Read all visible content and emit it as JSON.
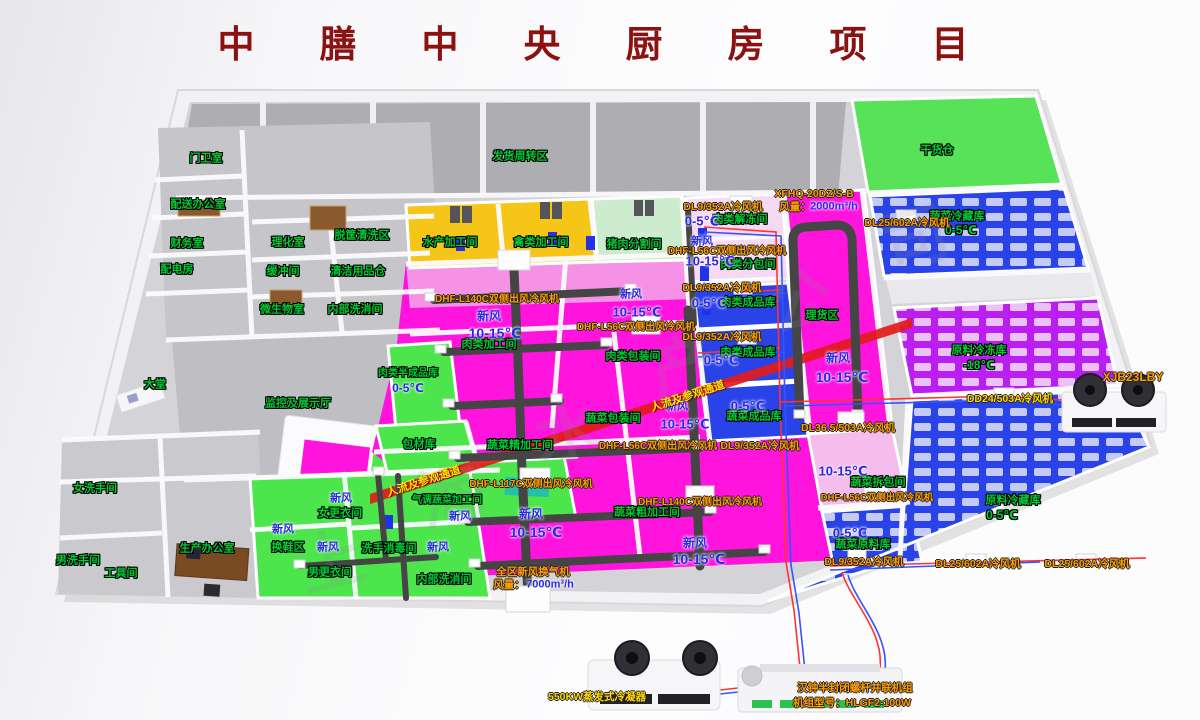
{
  "title": {
    "text": "中　膳　中　央　厨　房　项　目"
  },
  "colors": {
    "magenta_floor": "#ff14dd",
    "green_floor": "#4ce64c",
    "cold_blue_floor": "#2a43e8",
    "freezer_purple_floor": "#b81ff0",
    "yellow_room": "#f5c518",
    "pale_green_room": "#cdeccd",
    "dock_gray": "#aeaeb2",
    "light_pink": "#f4bdec",
    "corridor_red": "#e21b1b",
    "duct_gray": "#454545",
    "label_green": "#00cc33",
    "label_blue": "#2a2ae2",
    "label_orange": "#ff9d00",
    "label_yellow": "#ffd900",
    "title_red": "#8c1212"
  },
  "watermark": {
    "marks": [
      {
        "t": "上",
        "x": 330,
        "y": 557
      },
      {
        "t": "海",
        "x": 450,
        "y": 492
      },
      {
        "t": "水",
        "x": 566,
        "y": 428
      },
      {
        "t": "产",
        "x": 682,
        "y": 363
      },
      {
        "t": "公",
        "x": 798,
        "y": 298
      },
      {
        "t": "司",
        "x": 914,
        "y": 233
      }
    ]
  },
  "labels": [
    {
      "t": "门卫室",
      "x": 206,
      "y": 159,
      "c": "g"
    },
    {
      "t": "配送办公室",
      "x": 198,
      "y": 205,
      "c": "g"
    },
    {
      "t": "财务室",
      "x": 187,
      "y": 244,
      "c": "g"
    },
    {
      "t": "配电房",
      "x": 177,
      "y": 270,
      "c": "g"
    },
    {
      "t": "理化室",
      "x": 288,
      "y": 243,
      "c": "g"
    },
    {
      "t": "脱筐清洗区",
      "x": 362,
      "y": 236,
      "c": "g"
    },
    {
      "t": "缓冲间",
      "x": 283,
      "y": 272,
      "c": "g"
    },
    {
      "t": "清洁用品仓",
      "x": 358,
      "y": 272,
      "c": "g"
    },
    {
      "t": "微生物室",
      "x": 282,
      "y": 310,
      "c": "g"
    },
    {
      "t": "内部洗消间",
      "x": 355,
      "y": 310,
      "c": "g"
    },
    {
      "t": "大堂",
      "x": 155,
      "y": 385,
      "c": "g"
    },
    {
      "t": "监控及展示厅",
      "x": 298,
      "y": 404,
      "c": "g"
    },
    {
      "t": "女洗手间",
      "x": 95,
      "y": 489,
      "c": "g"
    },
    {
      "t": "男洗手间",
      "x": 78,
      "y": 561,
      "c": "g"
    },
    {
      "t": "工具间",
      "x": 121,
      "y": 574,
      "c": "g"
    },
    {
      "t": "生产办公室",
      "x": 207,
      "y": 549,
      "c": "g"
    },
    {
      "t": "换鞋区",
      "x": 288,
      "y": 548,
      "c": "g"
    },
    {
      "t": "女更衣间",
      "x": 340,
      "y": 514,
      "c": "g"
    },
    {
      "t": "男更衣间",
      "x": 330,
      "y": 573,
      "c": "g"
    },
    {
      "t": "洗手消毒间",
      "x": 389,
      "y": 549,
      "c": "g"
    },
    {
      "t": "包材库",
      "x": 419,
      "y": 445,
      "c": "g"
    },
    {
      "t": "气调蔬菜加工间",
      "x": 447,
      "y": 501,
      "c": "g",
      "fs": 10
    },
    {
      "t": "内部洗消间",
      "x": 444,
      "y": 580,
      "c": "g"
    },
    {
      "t": "水产加工间",
      "x": 450,
      "y": 243,
      "c": "g"
    },
    {
      "t": "禽类加工间",
      "x": 541,
      "y": 243,
      "c": "g"
    },
    {
      "t": "猪肉分割间",
      "x": 634,
      "y": 245,
      "c": "g"
    },
    {
      "t": "肉类加工间",
      "x": 489,
      "y": 345,
      "c": "g"
    },
    {
      "t": "肉类半成品库",
      "x": 408,
      "y": 374,
      "c": "g",
      "fs": 10
    },
    {
      "t": "肉类解冻间",
      "x": 740,
      "y": 220,
      "c": "g"
    },
    {
      "t": "肉类分包间",
      "x": 748,
      "y": 265,
      "c": "g"
    },
    {
      "t": "肉类成品库",
      "x": 748,
      "y": 303,
      "c": "g"
    },
    {
      "t": "肉类包装间",
      "x": 633,
      "y": 357,
      "c": "g"
    },
    {
      "t": "肉类成品库",
      "x": 748,
      "y": 353,
      "c": "g"
    },
    {
      "t": "理货区",
      "x": 822,
      "y": 316,
      "c": "g"
    },
    {
      "t": "蔬菜包装间",
      "x": 613,
      "y": 419,
      "c": "g"
    },
    {
      "t": "蔬菜成品库",
      "x": 754,
      "y": 417,
      "c": "g"
    },
    {
      "t": "蔬菜精加工间",
      "x": 520,
      "y": 446,
      "c": "g"
    },
    {
      "t": "蔬菜粗加工间",
      "x": 647,
      "y": 513,
      "c": "g"
    },
    {
      "t": "蔬菜拆包间",
      "x": 878,
      "y": 483,
      "c": "g"
    },
    {
      "t": "蔬菜原料库",
      "x": 863,
      "y": 545,
      "c": "g"
    },
    {
      "t": "干货仓",
      "x": 937,
      "y": 151,
      "c": "g"
    },
    {
      "t": "蔬菜冷藏库",
      "x": 957,
      "y": 217,
      "c": "g"
    },
    {
      "t": "0-5℃",
      "x": 961,
      "y": 230,
      "c": "g",
      "fs": 12
    },
    {
      "t": "原料冷冻库",
      "x": 979,
      "y": 351,
      "c": "g"
    },
    {
      "t": "-18℃",
      "x": 979,
      "y": 365,
      "c": "g",
      "fs": 12
    },
    {
      "t": "原料冷藏库",
      "x": 1013,
      "y": 501,
      "c": "g"
    },
    {
      "t": "0-5℃",
      "x": 1002,
      "y": 515,
      "c": "g",
      "fs": 12
    },
    {
      "t": "发货周转区",
      "x": 520,
      "y": 157,
      "c": "g"
    },
    {
      "t": "新风",
      "x": 489,
      "y": 316,
      "c": "b"
    },
    {
      "t": "10-15℃",
      "x": 495,
      "y": 333,
      "c": "b",
      "fs": 14
    },
    {
      "t": "0-5℃",
      "x": 702,
      "y": 221,
      "c": "b",
      "fs": 13
    },
    {
      "t": "新风",
      "x": 702,
      "y": 242,
      "c": "b",
      "fs": 11
    },
    {
      "t": "10-15℃",
      "x": 710,
      "y": 261,
      "c": "b",
      "fs": 13
    },
    {
      "t": "0-5℃",
      "x": 709,
      "y": 303,
      "c": "b",
      "fs": 13
    },
    {
      "t": "新风",
      "x": 631,
      "y": 295,
      "c": "b",
      "fs": 11
    },
    {
      "t": "10-15℃",
      "x": 637,
      "y": 312,
      "c": "b",
      "fs": 13
    },
    {
      "t": "0-5℃",
      "x": 721,
      "y": 360,
      "c": "b",
      "fs": 13
    },
    {
      "t": "新风",
      "x": 677,
      "y": 407,
      "c": "b",
      "fs": 11
    },
    {
      "t": "10-15℃",
      "x": 685,
      "y": 424,
      "c": "b",
      "fs": 13
    },
    {
      "t": "0-5℃",
      "x": 748,
      "y": 406,
      "c": "b",
      "fs": 13
    },
    {
      "t": "新风",
      "x": 531,
      "y": 514,
      "c": "b"
    },
    {
      "t": "10-15℃",
      "x": 536,
      "y": 532,
      "c": "b",
      "fs": 14
    },
    {
      "t": "新风",
      "x": 695,
      "y": 543,
      "c": "b"
    },
    {
      "t": "10-15℃",
      "x": 699,
      "y": 559,
      "c": "b",
      "fs": 14
    },
    {
      "t": "新风",
      "x": 838,
      "y": 358,
      "c": "b"
    },
    {
      "t": "10-15℃",
      "x": 842,
      "y": 377,
      "c": "b",
      "fs": 14
    },
    {
      "t": "10-15℃",
      "x": 843,
      "y": 471,
      "c": "b",
      "fs": 13
    },
    {
      "t": "0-5℃",
      "x": 850,
      "y": 533,
      "c": "b",
      "fs": 13
    },
    {
      "t": "0-5℃",
      "x": 408,
      "y": 388,
      "c": "b",
      "fs": 12
    },
    {
      "t": "新风",
      "x": 283,
      "y": 530,
      "c": "b",
      "fs": 11
    },
    {
      "t": "新风",
      "x": 341,
      "y": 499,
      "c": "b",
      "fs": 11
    },
    {
      "t": "新风",
      "x": 328,
      "y": 548,
      "c": "b",
      "fs": 11
    },
    {
      "t": "新风",
      "x": 438,
      "y": 548,
      "c": "b",
      "fs": 11
    },
    {
      "t": "新风",
      "x": 460,
      "y": 517,
      "c": "b",
      "fs": 11
    },
    {
      "t": "2000m³/h",
      "x": 834,
      "y": 207,
      "c": "b",
      "fs": 11
    },
    {
      "t": "7000m³/h",
      "x": 550,
      "y": 585,
      "c": "b",
      "fs": 11
    },
    {
      "t": "DL9/352A冷风机",
      "x": 723,
      "y": 207,
      "c": "o"
    },
    {
      "t": "DHF-L56C双侧出风冷风机",
      "x": 727,
      "y": 252,
      "c": "o",
      "fs": 10
    },
    {
      "t": "DL9/352A冷风机",
      "x": 722,
      "y": 288,
      "c": "o"
    },
    {
      "t": "DHF-L140C双侧出风冷风机",
      "x": 497,
      "y": 300,
      "c": "o",
      "fs": 10
    },
    {
      "t": "DHF-L56C双侧出风冷风机",
      "x": 636,
      "y": 328,
      "c": "o",
      "fs": 10
    },
    {
      "t": "DL9/352A冷风机",
      "x": 722,
      "y": 337,
      "c": "o"
    },
    {
      "t": "DHF-L56C双侧出风冷风机",
      "x": 658,
      "y": 447,
      "c": "o",
      "fs": 10
    },
    {
      "t": "DL9/352A冷风机",
      "x": 760,
      "y": 446,
      "c": "o"
    },
    {
      "t": "DHF-L140C双侧出风冷风机",
      "x": 700,
      "y": 503,
      "c": "o",
      "fs": 10
    },
    {
      "t": "DHF-L117C双侧出风冷风机",
      "x": 531,
      "y": 485,
      "c": "o",
      "fs": 10
    },
    {
      "t": "DL36.5/503A冷风机",
      "x": 848,
      "y": 428,
      "c": "o"
    },
    {
      "t": "DHF-L56C双侧出风冷风机",
      "x": 877,
      "y": 498,
      "c": "o",
      "fs": 9.5
    },
    {
      "t": "DL9/352A冷风机",
      "x": 864,
      "y": 562,
      "c": "o"
    },
    {
      "t": "DL25/602A冷风机",
      "x": 978,
      "y": 564,
      "c": "o"
    },
    {
      "t": "DL25/602A冷风机",
      "x": 1087,
      "y": 564,
      "c": "o"
    },
    {
      "t": "DL25/602A冷风机",
      "x": 907,
      "y": 223,
      "c": "o"
    },
    {
      "t": "XFHQ-20DZ/S-B",
      "x": 814,
      "y": 194,
      "c": "o"
    },
    {
      "t": "风量：",
      "x": 795,
      "y": 207,
      "c": "o"
    },
    {
      "t": "全区新风换气机",
      "x": 533,
      "y": 572,
      "c": "o"
    },
    {
      "t": "风量：",
      "x": 509,
      "y": 585,
      "c": "o"
    },
    {
      "t": "XJB23LBY",
      "x": 1133,
      "y": 377,
      "c": "o",
      "fs": 12
    },
    {
      "t": "汉钟半封闭螺杆并联机组",
      "x": 855,
      "y": 688,
      "c": "o"
    },
    {
      "t": "机组型号：HLGF2-100W",
      "x": 852,
      "y": 703,
      "c": "o"
    },
    {
      "t": "DD24/503A冷风机",
      "x": 1010,
      "y": 399,
      "c": "y"
    },
    {
      "t": "550KW蒸发式冷凝器",
      "x": 597,
      "y": 697,
      "c": "y"
    },
    {
      "t": "人流及参观通道",
      "x": 424,
      "y": 482,
      "c": "band",
      "r": -18
    },
    {
      "t": "人流及参观通道",
      "x": 688,
      "y": 397,
      "c": "band",
      "r": -18
    }
  ]
}
